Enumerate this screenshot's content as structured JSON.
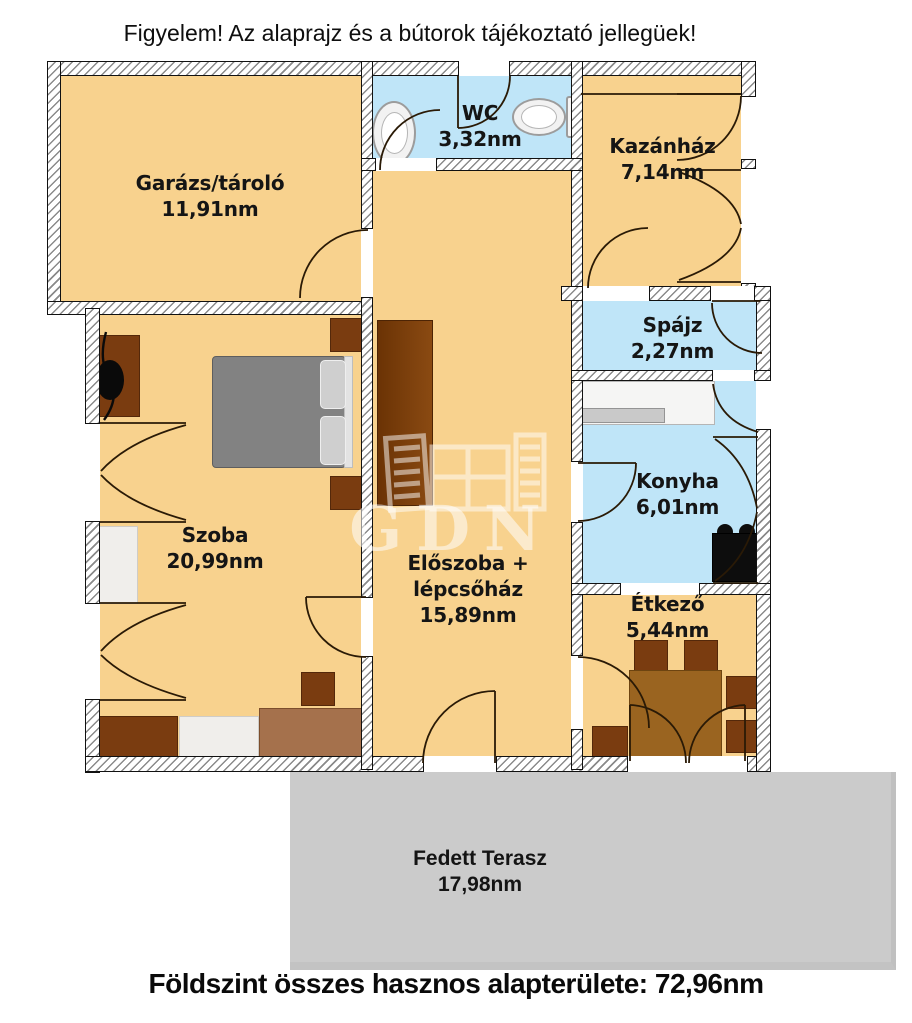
{
  "notice": {
    "text": "Figyelem! Az alaprajz és a bútorok tájékoztató jellegüek!"
  },
  "rooms": {
    "garage": {
      "name": "Garázs/tároló",
      "area": "11,91nm"
    },
    "wc": {
      "name": "WC",
      "area": "3,32nm"
    },
    "boiler": {
      "name": "Kazánház",
      "area": "7,14nm"
    },
    "pantry": {
      "name": "Spájz",
      "area": "2,27nm"
    },
    "kitchen": {
      "name": "Konyha",
      "area": "6,01nm"
    },
    "bedroom": {
      "name": "Szoba",
      "area": "20,99nm"
    },
    "hall": {
      "name": "Előszoba + lépcsőház",
      "area": "15,89nm"
    },
    "dining": {
      "name": "Étkező",
      "area": "5,44nm"
    },
    "terrace": {
      "name": "Fedett Terasz",
      "area": "17,98nm"
    }
  },
  "footer": {
    "text": "Földszint összes hasznos alapterülete: 72,96nm"
  },
  "watermark": {
    "text": "GDN"
  },
  "icons": {
    "washbasin": "washbasin-icon",
    "toilet": "toilet-icon",
    "stove": "stove-icon"
  },
  "colors": {
    "room_fill": "#f8d28e",
    "wet_room_fill": "#bfe5f8",
    "terrace_fill": "#cbcbcb",
    "furniture_dark_brown": "#7a3c10",
    "furniture_mid_brown": "#a5714c",
    "bed_gray": "#828282",
    "stove_black": "#0d0d0d",
    "wall_line": "#111111"
  }
}
